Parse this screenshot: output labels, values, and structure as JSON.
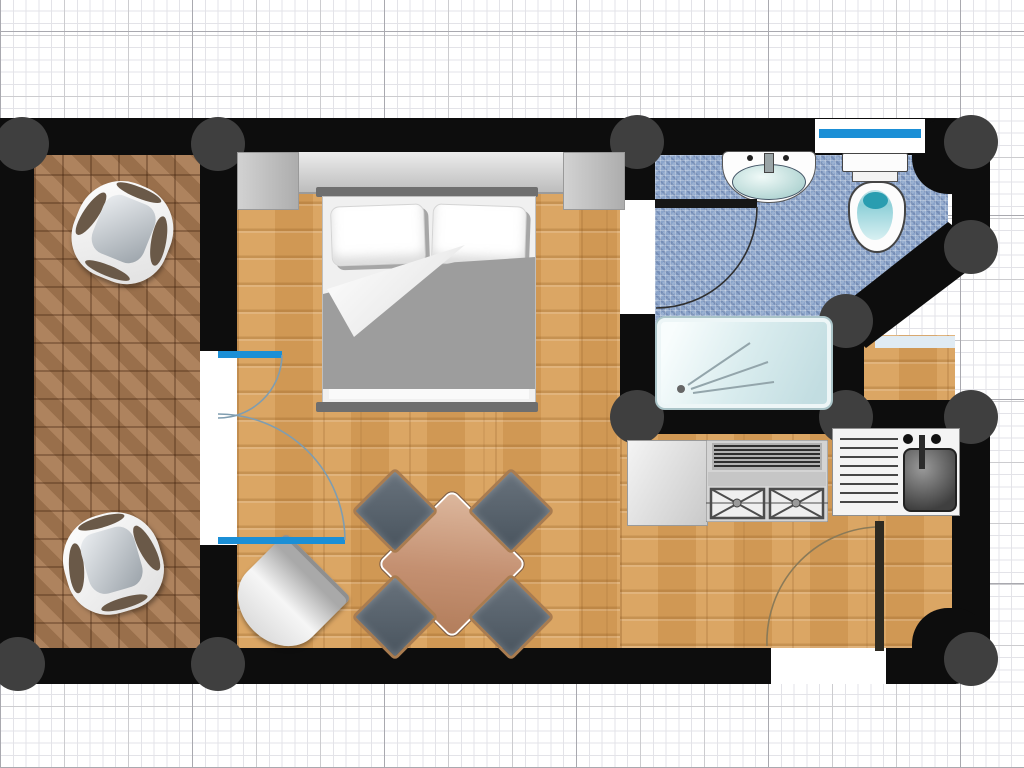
{
  "title": "studio-apartment-floor-plan",
  "scene": {
    "type": "floor-plan",
    "view": "top-down",
    "background": "graph-paper-grid",
    "text_labels": "none"
  },
  "colors": {
    "paper": "#ffffff",
    "grid-minor": "#e3e3e8",
    "grid-major": "#cccccf",
    "grid-bold": "#a9a9af",
    "wall": "#0d0d0d",
    "column": "#3f3f3f",
    "accent": "#1b8fd6",
    "wood": "#d9a05a",
    "tile": "#a87a52",
    "mosaic": "#8ba4ca",
    "blanket": "#9d9d9d",
    "opening-white": "#ffffff",
    "shower-glass": "#d9ecee",
    "fixture-white": "#fcfcfc",
    "steel-dark": "#3f3f3f"
  },
  "rooms": [
    {
      "id": "balcony",
      "floor": "terracotta-tile",
      "position": "left"
    },
    {
      "id": "living-bedroom",
      "floor": "oak-parquet",
      "position": "center"
    },
    {
      "id": "bathroom",
      "floor": "blue-mosaic",
      "position": "top-right",
      "wall": "angled-diagonal"
    },
    {
      "id": "kitchen",
      "floor": "oak-parquet",
      "position": "bottom-right"
    }
  ],
  "furniture": [
    {
      "id": "balcony-chair-1",
      "room": "balcony"
    },
    {
      "id": "balcony-chair-2",
      "room": "balcony"
    },
    {
      "id": "wardrobe",
      "room": "living-bedroom"
    },
    {
      "id": "double-bed",
      "room": "living-bedroom",
      "pillows": 2
    },
    {
      "id": "dining-table",
      "room": "living-bedroom",
      "chairs": 4,
      "rotation_deg": 45
    },
    {
      "id": "lounge-chair",
      "room": "living-bedroom"
    },
    {
      "id": "bathroom-sink",
      "room": "bathroom"
    },
    {
      "id": "toilet",
      "room": "bathroom"
    },
    {
      "id": "shower",
      "room": "bathroom"
    },
    {
      "id": "worktop",
      "room": "kitchen"
    },
    {
      "id": "stove",
      "room": "kitchen",
      "burners": 2
    },
    {
      "id": "kitchen-sink",
      "room": "kitchen"
    }
  ],
  "openings": [
    {
      "id": "balcony-french-door",
      "leaves": 2,
      "color": "accent"
    },
    {
      "id": "bathroom-door",
      "swing": "into-bathroom"
    },
    {
      "id": "entrance-door",
      "wall": "bottom",
      "swing": "into-kitchen"
    },
    {
      "id": "bathroom-window",
      "wall": "top",
      "color": "accent"
    }
  ],
  "structure": {
    "columns": 12,
    "wall_corners_rounded": [
      "top-right",
      "bottom-right"
    ]
  }
}
